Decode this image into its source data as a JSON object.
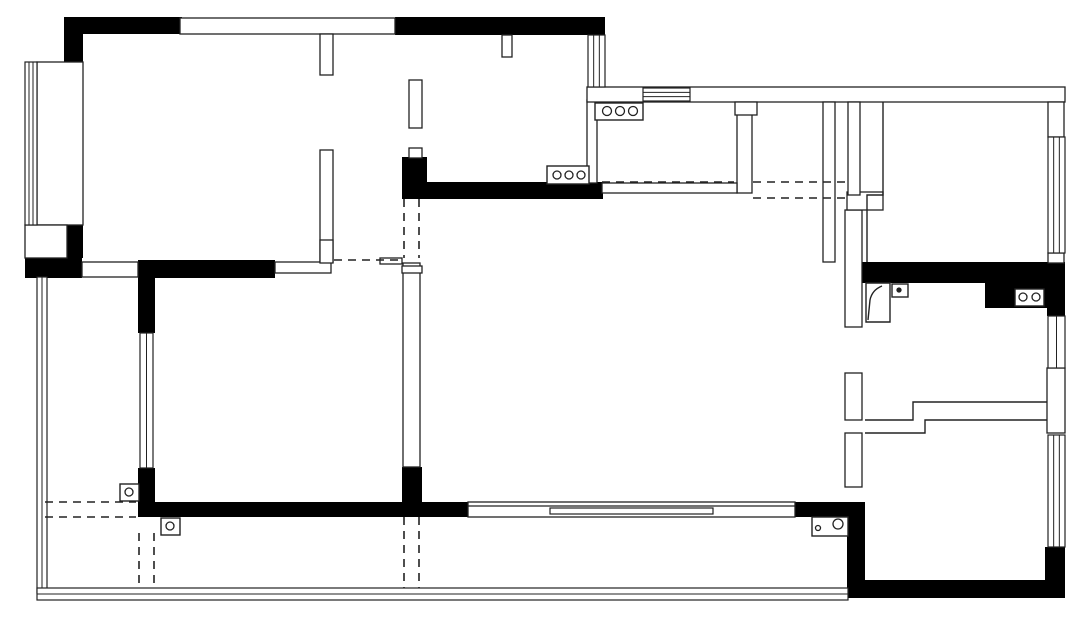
{
  "meta": {
    "document_type": "residential floor plan drawing",
    "canvas_width": 1080,
    "canvas_height": 618,
    "colors": {
      "background": "#ffffff",
      "wall_fill": "#000000",
      "line": "#222222"
    }
  },
  "plan": {
    "black_rects": [
      {
        "name": "wall-top-bedroom1",
        "x": 64,
        "y": 17,
        "w": 118,
        "h": 17
      },
      {
        "name": "wall-corner-bedroom1",
        "x": 64,
        "y": 34,
        "w": 19,
        "h": 34
      },
      {
        "name": "wall-top-kitchen",
        "x": 395,
        "y": 17,
        "w": 210,
        "h": 18
      },
      {
        "name": "wall-stub-bay-bottom",
        "x": 65,
        "y": 225,
        "w": 18,
        "h": 33
      },
      {
        "name": "wall-block-terrace-top",
        "x": 25,
        "y": 258,
        "w": 57,
        "h": 20
      },
      {
        "name": "wall-divider-bedrooms",
        "x": 138,
        "y": 260,
        "w": 137,
        "h": 18
      },
      {
        "name": "column-kitchen-sw",
        "x": 402,
        "y": 157,
        "w": 25,
        "h": 42
      },
      {
        "name": "wall-kitchen-south",
        "x": 427,
        "y": 182,
        "w": 176,
        "h": 17
      },
      {
        "name": "wall-bath-north",
        "x": 847,
        "y": 262,
        "w": 218,
        "h": 21
      },
      {
        "name": "wall-bath-ne",
        "x": 985,
        "y": 283,
        "w": 80,
        "h": 25
      },
      {
        "name": "wall-bath-east-upper",
        "x": 1047,
        "y": 283,
        "w": 18,
        "h": 33
      },
      {
        "name": "column-living-sw",
        "x": 402,
        "y": 467,
        "w": 20,
        "h": 50
      },
      {
        "name": "wall-bedroom2-west-lower",
        "x": 138,
        "y": 468,
        "w": 17,
        "h": 49
      },
      {
        "name": "wall-bedroom2-south",
        "x": 138,
        "y": 502,
        "w": 330,
        "h": 15
      },
      {
        "name": "wall-living-south-east",
        "x": 795,
        "y": 502,
        "w": 65,
        "h": 15
      },
      {
        "name": "wall-bedroom2-west-upper",
        "x": 138,
        "y": 262,
        "w": 17,
        "h": 71
      },
      {
        "name": "wall-bedroom3-west",
        "x": 847,
        "y": 502,
        "w": 18,
        "h": 96
      },
      {
        "name": "wall-bedroom3-south",
        "x": 847,
        "y": 580,
        "w": 216,
        "h": 18
      },
      {
        "name": "wall-bedroom3-se",
        "x": 1045,
        "y": 547,
        "w": 20,
        "h": 51
      }
    ],
    "white_rects": [
      {
        "name": "band-top-window-area",
        "x": 180,
        "y": 18,
        "w": 215,
        "h": 16
      },
      {
        "name": "bay-window-seat",
        "x": 37,
        "y": 62,
        "w": 46,
        "h": 163
      },
      {
        "name": "cabinet-niche",
        "x": 25,
        "y": 225,
        "w": 42,
        "h": 33
      },
      {
        "name": "door-threshold-terrace",
        "x": 82,
        "y": 262,
        "w": 56,
        "h": 15
      },
      {
        "name": "wall-bedroom2-north-thin",
        "x": 275,
        "y": 262,
        "w": 56,
        "h": 11
      },
      {
        "name": "wall-bedroom1-east-a",
        "x": 320,
        "y": 34,
        "w": 13,
        "h": 41
      },
      {
        "name": "wall-bedroom1-east-b",
        "x": 320,
        "y": 150,
        "w": 13,
        "h": 112
      },
      {
        "name": "wall-kitchen-west-a",
        "x": 409,
        "y": 80,
        "w": 13,
        "h": 48
      },
      {
        "name": "wall-kitchen-west-b",
        "x": 409,
        "y": 148,
        "w": 13,
        "h": 10
      },
      {
        "name": "wall-kitchen-east-lower",
        "x": 587,
        "y": 100,
        "w": 10,
        "h": 83
      },
      {
        "name": "wall-pantry-east",
        "x": 737,
        "y": 102,
        "w": 15,
        "h": 91
      },
      {
        "name": "band-top-wall-right",
        "x": 587,
        "y": 87,
        "w": 478,
        "h": 15
      },
      {
        "name": "pillar-step",
        "x": 735,
        "y": 102,
        "w": 22,
        "h": 13
      },
      {
        "name": "wall-corridor-east",
        "x": 823,
        "y": 102,
        "w": 12,
        "h": 160
      },
      {
        "name": "wall-living-east-a",
        "x": 845,
        "y": 210,
        "w": 17,
        "h": 117
      },
      {
        "name": "wall-living-east-b",
        "x": 845,
        "y": 373,
        "w": 17,
        "h": 47
      },
      {
        "name": "wall-living-east-c",
        "x": 845,
        "y": 433,
        "w": 17,
        "h": 54
      },
      {
        "name": "wall-bedroom2-east",
        "x": 403,
        "y": 263,
        "w": 17,
        "h": 204
      },
      {
        "name": "low-wall-pantry-south",
        "x": 602,
        "y": 183,
        "w": 135,
        "h": 10
      },
      {
        "name": "wall-jog-bath-door",
        "x": 847,
        "y": 192,
        "w": 36,
        "h": 18
      },
      {
        "name": "wall-bath-east-block",
        "x": 1047,
        "y": 368,
        "w": 18,
        "h": 65
      },
      {
        "name": "wall-bedroom4-east-top",
        "x": 1048,
        "y": 102,
        "w": 16,
        "h": 35
      },
      {
        "name": "wall-bedroom4-east-mid",
        "x": 1048,
        "y": 253,
        "w": 16,
        "h": 10
      },
      {
        "name": "wall-duct",
        "x": 848,
        "y": 102,
        "w": 12,
        "h": 93
      },
      {
        "name": "kitchen-flue",
        "x": 502,
        "y": 35,
        "w": 10,
        "h": 22
      },
      {
        "name": "wall-jog-bedroom2-ne",
        "x": 320,
        "y": 240,
        "w": 13,
        "h": 23
      },
      {
        "name": "wall-piece-hall-a",
        "x": 380,
        "y": 258,
        "w": 22,
        "h": 6
      },
      {
        "name": "wall-piece-hall-b",
        "x": 402,
        "y": 266,
        "w": 20,
        "h": 7
      }
    ],
    "windows": [
      {
        "name": "bay-window-glazing",
        "x": 25,
        "y": 62,
        "w": 12,
        "h": 163,
        "dir": "v",
        "inner": 2
      },
      {
        "name": "terrace-west-railing",
        "x": 37,
        "y": 277,
        "w": 10,
        "h": 316,
        "dir": "v",
        "inner": 1
      },
      {
        "name": "balcony-south-railing",
        "x": 37,
        "y": 588,
        "w": 811,
        "h": 12,
        "dir": "h",
        "inner": 1
      },
      {
        "name": "bedroom2-west-window",
        "x": 140,
        "y": 333,
        "w": 13,
        "h": 135,
        "dir": "v",
        "inner": 1
      },
      {
        "name": "kitchen-east-window",
        "x": 588,
        "y": 35,
        "w": 17,
        "h": 52,
        "dir": "v",
        "inner": 2
      },
      {
        "name": "pantry-north-window",
        "x": 643,
        "y": 88,
        "w": 47,
        "h": 13,
        "dir": "h",
        "inner": 2
      },
      {
        "name": "bedroom4-east-window",
        "x": 1048,
        "y": 137,
        "w": 17,
        "h": 116,
        "dir": "v",
        "inner": 2
      },
      {
        "name": "bath-east-window",
        "x": 1048,
        "y": 316,
        "w": 17,
        "h": 52,
        "dir": "v",
        "inner": 1
      },
      {
        "name": "bedroom3-east-window",
        "x": 1048,
        "y": 435,
        "w": 17,
        "h": 112,
        "dir": "v",
        "inner": 2
      }
    ],
    "sliding_door": {
      "name": "living-south-sliding-door",
      "outer": {
        "x": 468,
        "y": 502,
        "w": 327,
        "h": 15
      },
      "track_y": 506,
      "panel": {
        "x": 550,
        "y": 508,
        "w": 163,
        "h": 6
      }
    },
    "solid_paths": [
      {
        "name": "bedroom4-closet-wall",
        "d": "M883 102 L883 195 L867 195 L867 262"
      },
      {
        "name": "bath-south-step-wall",
        "d": "M865 420 L913 420 L913 402 L1047 402"
      },
      {
        "name": "bedroom3-north-step-wall",
        "d": "M865 433 L925 433 L925 420 L1047 420"
      },
      {
        "name": "shower-door-outline",
        "d": "M866 283 L890 283 L890 322 L866 322 Z"
      },
      {
        "name": "shower-door-leaf",
        "d": "M868 320 L870 300 Q872 290 882 286"
      }
    ],
    "dashed_lines": [
      {
        "name": "beam-hall",
        "x1": 334,
        "y1": 260,
        "x2": 402,
        "y2": 260
      },
      {
        "name": "opening-hall-west",
        "x1": 404,
        "y1": 199,
        "x2": 404,
        "y2": 258
      },
      {
        "name": "opening-hall-east",
        "x1": 419,
        "y1": 199,
        "x2": 419,
        "y2": 258
      },
      {
        "name": "beam-pantry",
        "x1": 602,
        "y1": 182,
        "x2": 734,
        "y2": 182
      },
      {
        "name": "beam-corridor-a",
        "x1": 753,
        "y1": 182,
        "x2": 845,
        "y2": 182
      },
      {
        "name": "beam-corridor-b",
        "x1": 753,
        "y1": 198,
        "x2": 845,
        "y2": 198
      },
      {
        "name": "beam-terrace-a",
        "x1": 45,
        "y1": 502,
        "x2": 136,
        "y2": 502
      },
      {
        "name": "beam-terrace-b",
        "x1": 45,
        "y1": 517,
        "x2": 136,
        "y2": 517
      },
      {
        "name": "beam-balcony-left-a",
        "x1": 139,
        "y1": 533,
        "x2": 139,
        "y2": 588
      },
      {
        "name": "beam-balcony-left-b",
        "x1": 154,
        "y1": 533,
        "x2": 154,
        "y2": 588
      },
      {
        "name": "beam-balcony-mid-a",
        "x1": 404,
        "y1": 517,
        "x2": 404,
        "y2": 588
      },
      {
        "name": "beam-balcony-mid-b",
        "x1": 419,
        "y1": 517,
        "x2": 419,
        "y2": 588
      }
    ],
    "fixtures": [
      {
        "name": "stove-symbol",
        "box": {
          "x": 547,
          "y": 166,
          "w": 42,
          "h": 18
        },
        "circles": [
          {
            "cx": 557,
            "cy": 175,
            "r": 4
          },
          {
            "cx": 569,
            "cy": 175,
            "r": 4
          },
          {
            "cx": 581,
            "cy": 175,
            "r": 4
          }
        ]
      },
      {
        "name": "counter-hob-symbol",
        "box": {
          "x": 595,
          "y": 103,
          "w": 48,
          "h": 17
        },
        "circles": [
          {
            "cx": 607,
            "cy": 111,
            "r": 4.5
          },
          {
            "cx": 620,
            "cy": 111,
            "r": 4.5
          },
          {
            "cx": 633,
            "cy": 111,
            "r": 4.5
          }
        ]
      },
      {
        "name": "basin-symbol",
        "box": {
          "x": 1015,
          "y": 289,
          "w": 29,
          "h": 17
        },
        "circles": [
          {
            "cx": 1023,
            "cy": 297,
            "r": 4
          },
          {
            "cx": 1036,
            "cy": 297,
            "r": 4
          }
        ]
      },
      {
        "name": "washer-symbol",
        "box": {
          "x": 812,
          "y": 517,
          "w": 36,
          "h": 19
        },
        "circles": [
          {
            "cx": 818,
            "cy": 528,
            "r": 2.5
          },
          {
            "cx": 838,
            "cy": 524,
            "r": 5
          }
        ]
      },
      {
        "name": "floor-drain-symbol-1",
        "box": {
          "x": 120,
          "y": 484,
          "w": 19,
          "h": 17
        },
        "circles": [
          {
            "cx": 129,
            "cy": 492,
            "r": 4
          }
        ]
      },
      {
        "name": "floor-drain-symbol-2",
        "box": {
          "x": 161,
          "y": 518,
          "w": 19,
          "h": 17
        },
        "circles": [
          {
            "cx": 170,
            "cy": 526,
            "r": 4
          }
        ]
      },
      {
        "name": "junction-box-symbol",
        "box": {
          "x": 892,
          "y": 284,
          "w": 16,
          "h": 13
        },
        "circles": [
          {
            "cx": 899,
            "cy": 290,
            "r": 2,
            "filled": true
          }
        ]
      }
    ]
  }
}
